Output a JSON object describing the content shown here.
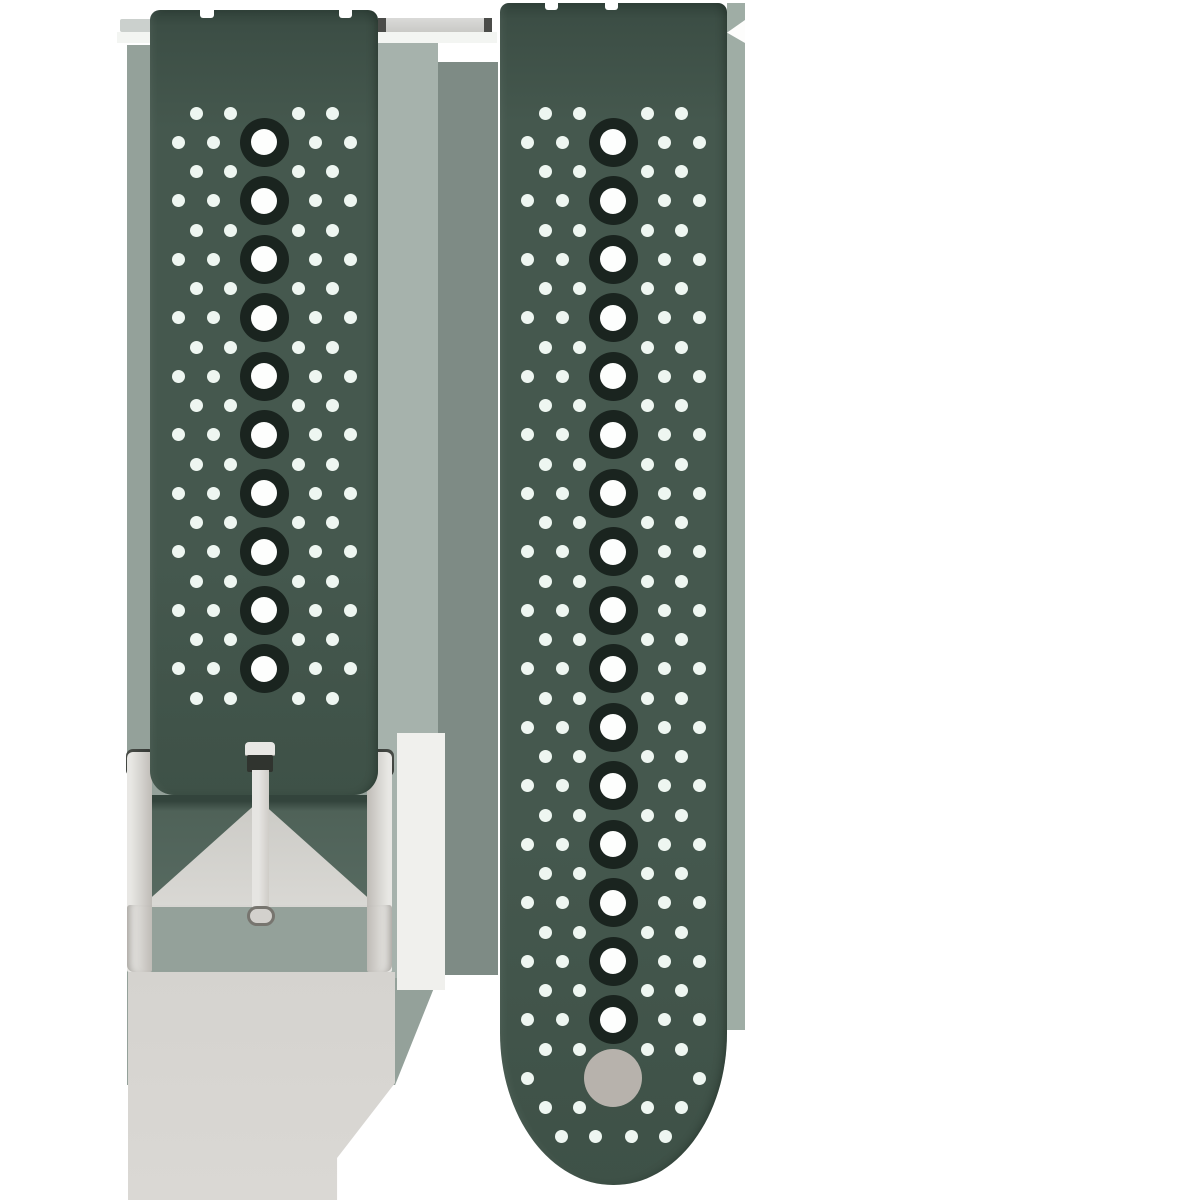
{
  "scene": {
    "description": "Product photo of a two-piece dark green perforated silicone quick-release watch strap with a brushed silver buckle on a white background",
    "objects": [
      "short-strap-piece-with-buckle",
      "long-strap-piece-with-holes",
      "spring-bar-pin",
      "metal-buckle"
    ]
  },
  "colors": {
    "canvas_bg": "#ffffff",
    "strap_green": "#45584e",
    "strap_green_top": "#31423a",
    "strap_green_deep": "#3e5147",
    "hole_ring": "#1a241f",
    "hole_white": "#fdfefd",
    "dot_white": "#eef6f1",
    "band_left": "#94a19a",
    "band_left_light": "#a6b2ac",
    "band_mid": "#7e8b85",
    "band_right": "#9fada5",
    "metal_light": "#e8e7e4",
    "metal": "#d5d3cf",
    "metal_dark": "#aeaba5",
    "tang_dark": "#30342f",
    "wedge_green": "#4f6258",
    "wedge_top_shadow": "#33443c",
    "pale_metal": "#d9d8d4",
    "shadow_gray": "#d5d3cf",
    "end_circle": "#b7b2ac",
    "pin_gray": "#c9c9c6",
    "pin_dark": "#4b4c49",
    "highlight_white": "#f3f5f2"
  },
  "pattern": {
    "row_spacing": 29.25,
    "dot_diameter": 13,
    "hole_outer_diameter": 49,
    "hole_inner_diameter": 26,
    "offsets_hole_row": [
      51,
      86
    ],
    "offsets_between_row": [
      34,
      68
    ]
  },
  "left_strap": {
    "x": 150,
    "y": 10,
    "width": 228,
    "height": 785,
    "center_x": 264,
    "first_row_y": 113,
    "rows": 21,
    "hole_rows_max": 19,
    "hole_count": 10,
    "lug_notches": [
      {
        "x": 200,
        "y": 10,
        "w": 14,
        "h": 8
      },
      {
        "x": 339,
        "y": 10,
        "w": 13,
        "h": 8
      }
    ]
  },
  "right_strap": {
    "x": 500,
    "y": 3,
    "width": 227,
    "height": 1182,
    "center_x": 613,
    "first_row_y": 113,
    "rows": 36,
    "hole_rows_max": 31,
    "hole_count": 16,
    "special_rows": {
      "33": [
        86
      ],
      "35": [
        18,
        52
      ]
    },
    "end_circle": {
      "cx": 613,
      "cy": 1078,
      "diameter": 58
    },
    "lug_notches": [
      {
        "x": 545,
        "y": 3,
        "w": 13,
        "h": 7
      },
      {
        "x": 605,
        "y": 3,
        "w": 13,
        "h": 7
      }
    ]
  }
}
